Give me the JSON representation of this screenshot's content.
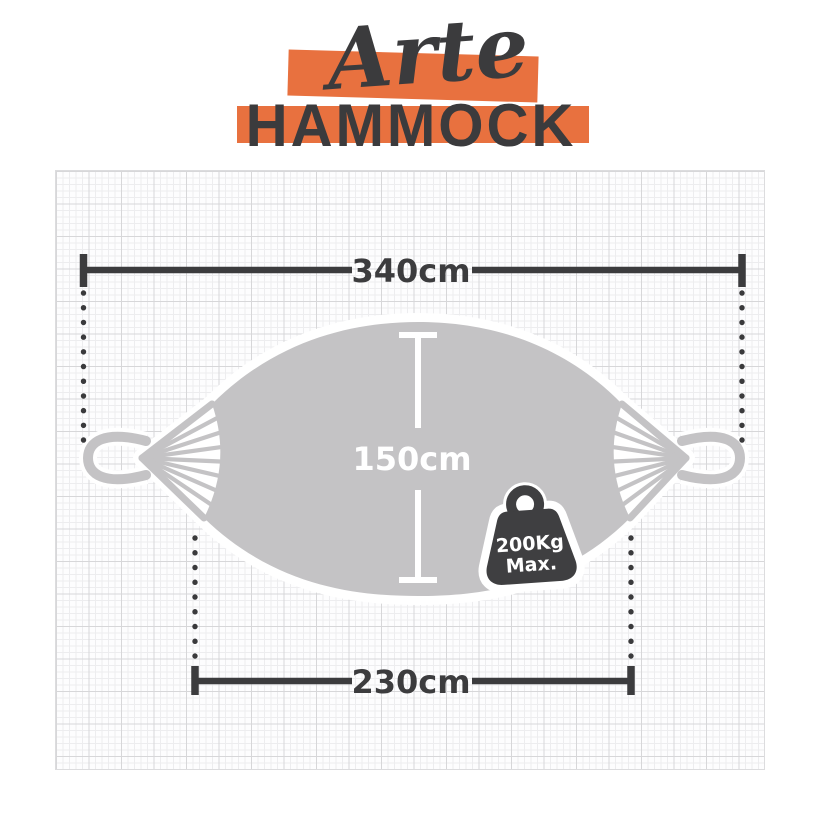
{
  "brand": {
    "script_word": "Arte",
    "block_word": "HAMMOCK"
  },
  "measurements": {
    "total_length": "340cm",
    "bed_width": "150cm",
    "bed_length": "230cm",
    "max_weight_value": "200Kg",
    "max_weight_suffix": "Max."
  },
  "colors": {
    "accent_orange": "#E8713F",
    "ink_dark": "#3C3C3E",
    "hammock_gray": "#C4C3C5",
    "paper_white": "#FDFDFE",
    "grid_minor": "#EDEDEF",
    "grid_major": "#D7D7D9"
  }
}
